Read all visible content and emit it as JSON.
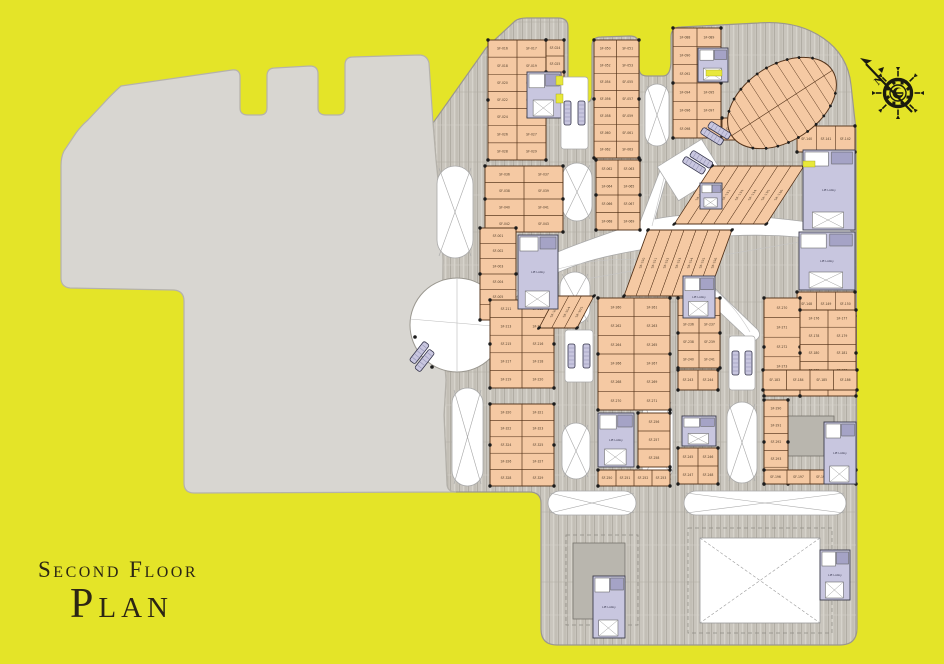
{
  "title": {
    "line1": "Second Floor",
    "line2": "Plan"
  },
  "compass": {
    "north_label": "N",
    "cx": 898,
    "cy": 93
  },
  "palette": {
    "bg": "#e4e428",
    "mass": "#d8d6d1",
    "mass_edge": "#b5b2ab",
    "hatch_base": "#c9c5bd",
    "hatch_line_dark": "#b1ada4",
    "hatch_line_light": "#d6d3cb",
    "shop_fill": "#f5c9a3",
    "shop_edge": "#54331a",
    "core_fill": "#c8c6df",
    "core_edge": "#3b3b4a",
    "core_dark": "#a5a3c6",
    "void_line": "#a8a8a8",
    "ink": "#1b1b0e",
    "label": "#4e3c29",
    "solid_block": "#b9b6ae",
    "highlight": "#e8e83a"
  },
  "plan": {
    "unit_prefix": "SF-",
    "core_label": "Lift Lobby",
    "mall_outline": "M486,48 L515,21 Q519,18 527,18 L558,18 Q568,18 568,27 L568,95 Q568,103 576,103 L584,103 Q592,103 592,95 L592,46 Q592,37 601,37 L630,36 Q639,36 639,45 L639,68 Q639,76 647,76 L663,76 Q671,76 671,60 L671,37 Q671,27 681,27 L758,23 Q797,20 823,38 Q848,55 851,85 L856,130 L857,628 Q857,645 840,645 L557,645 Q541,645 541,629 L541,503 Q541,492 529,492 L455,492 Q448,492 447,485 L444,415 L446,380 L442,330 L443,260 L440,200 L436,160 L433,123 Z",
    "mass_outline": "M121,86 L232,70 Q240,69 240,77 L240,108 Q240,115 248,115 L260,115 Q267,115 267,108 L267,76 Q267,68 275,68 L310,66 Q318,66 318,74 L318,108 Q318,115 326,115 L338,115 Q345,115 345,108 L345,65 Q345,57 353,57 L419,55 Q427,55 429,63 L433,123 L436,160 L440,200 L443,260 L442,330 L446,380 L444,415 L447,485 Q448,492 456,492 L194,493 Q184,493 184,483 L184,301 Q184,291 174,290 L70,288 Q61,287 61,278 L61,166 Q61,157 64,151 L76,133 Q82,125 88,120 L103,104 Q111,95 121,86 Z",
    "butterfly": "M503,282 C545,252 590,240 640,222 L661,168 C664,161 670,162 669,169 L655,219 C700,210 750,215 800,221 L846,227 Q852,229 852,236 Q852,243 845,242 L798,237 C752,233 706,236 668,243 L758,330 Q762,336 756,340 Q751,344 746,337 L652,248 C600,256 556,266 512,300 Q505,305 501,298 Q498,290 503,282 Z",
    "butterfly_lines": [
      "M505,293 L845,234",
      "M520,282 C610,246 700,246 750,332",
      "M652,226 L666,170"
    ],
    "walkway": {
      "x": 664,
      "y": 150,
      "w": 52,
      "h": 40,
      "rot": -32
    },
    "atrium_circle": {
      "cx": 457,
      "cy": 325,
      "r": 47
    },
    "blocks": [
      {
        "x": 488,
        "y": 40,
        "w": 58,
        "h": 120,
        "cols": 2,
        "rows": 7,
        "start": 16
      },
      {
        "x": 546,
        "y": 40,
        "w": 18,
        "h": 64,
        "cols": 1,
        "rows": 4,
        "start": 24
      },
      {
        "x": 594,
        "y": 40,
        "w": 45,
        "h": 118,
        "cols": 2,
        "rows": 7,
        "start": 50
      },
      {
        "x": 673,
        "y": 28,
        "w": 48,
        "h": 110,
        "cols": 2,
        "rows": 6,
        "start": 88
      },
      {
        "x": 797,
        "y": 126,
        "w": 58,
        "h": 26,
        "cols": 3,
        "rows": 1,
        "start": 140
      },
      {
        "x": 797,
        "y": 292,
        "w": 58,
        "h": 24,
        "cols": 3,
        "rows": 1,
        "start": 148
      },
      {
        "x": 485,
        "y": 166,
        "w": 78,
        "h": 66,
        "cols": 2,
        "rows": 4,
        "start": 36
      },
      {
        "x": 480,
        "y": 228,
        "w": 36,
        "h": 92,
        "cols": 1,
        "rows": 6,
        "start": 1
      },
      {
        "x": 490,
        "y": 300,
        "w": 64,
        "h": 88,
        "cols": 2,
        "rows": 5,
        "start": 211
      },
      {
        "x": 490,
        "y": 404,
        "w": 64,
        "h": 82,
        "cols": 2,
        "rows": 5,
        "start": 320
      },
      {
        "x": 598,
        "y": 298,
        "w": 72,
        "h": 112,
        "cols": 2,
        "rows": 6,
        "start": 260
      },
      {
        "x": 638,
        "y": 413,
        "w": 32,
        "h": 54,
        "cols": 1,
        "rows": 3,
        "start": 256
      },
      {
        "x": 598,
        "y": 470,
        "w": 72,
        "h": 16,
        "cols": 4,
        "rows": 1,
        "start": 250
      },
      {
        "x": 678,
        "y": 298,
        "w": 42,
        "h": 70,
        "cols": 2,
        "rows": 4,
        "start": 234
      },
      {
        "x": 678,
        "y": 370,
        "w": 40,
        "h": 20,
        "cols": 2,
        "rows": 1,
        "start": 243
      },
      {
        "x": 678,
        "y": 448,
        "w": 40,
        "h": 36,
        "cols": 2,
        "rows": 2,
        "start": 245
      },
      {
        "x": 764,
        "y": 298,
        "w": 36,
        "h": 98,
        "cols": 1,
        "rows": 5,
        "start": 270
      },
      {
        "x": 764,
        "y": 400,
        "w": 24,
        "h": 84,
        "cols": 1,
        "rows": 5,
        "start": 290
      },
      {
        "x": 800,
        "y": 310,
        "w": 56,
        "h": 86,
        "cols": 2,
        "rows": 5,
        "start": 176
      },
      {
        "x": 763,
        "y": 370,
        "w": 94,
        "h": 20,
        "cols": 4,
        "rows": 1,
        "start": 183
      },
      {
        "x": 764,
        "y": 470,
        "w": 92,
        "h": 14,
        "cols": 4,
        "rows": 1,
        "start": 196
      },
      {
        "x": 596,
        "y": 160,
        "w": 44,
        "h": 70,
        "cols": 2,
        "rows": 4,
        "start": 62
      },
      {
        "x": 722,
        "y": 118,
        "w": 56,
        "h": 22,
        "cols": 3,
        "rows": 1,
        "start": 110
      }
    ],
    "fans": [
      {
        "x": 648,
        "y": 230,
        "w": 84,
        "h": 66,
        "cols": 7,
        "skew": -20,
        "start": 150
      },
      {
        "x": 712,
        "y": 166,
        "w": 92,
        "h": 58,
        "cols": 7,
        "skew": -33,
        "start": 130
      },
      {
        "x": 556,
        "y": 296,
        "w": 38,
        "h": 32,
        "cols": 3,
        "skew": -28,
        "start": 203
      }
    ],
    "leaf": {
      "cx": 782,
      "cy": 103,
      "rx": 60,
      "ry": 38,
      "rot": -33,
      "chord_step": 11,
      "start": 115
    },
    "voids": [
      {
        "x": 437,
        "y": 166,
        "w": 36,
        "h": 92,
        "type": "x"
      },
      {
        "x": 452,
        "y": 388,
        "w": 31,
        "h": 98,
        "type": "x"
      },
      {
        "x": 645,
        "y": 84,
        "w": 24,
        "h": 62,
        "type": "x"
      },
      {
        "x": 562,
        "y": 163,
        "w": 30,
        "h": 58,
        "type": "x"
      },
      {
        "x": 560,
        "y": 272,
        "w": 30,
        "h": 52,
        "type": "x"
      },
      {
        "x": 562,
        "y": 423,
        "w": 28,
        "h": 56,
        "type": "x"
      },
      {
        "x": 642,
        "y": 400,
        "w": 31,
        "h": 82,
        "type": "x"
      },
      {
        "x": 727,
        "y": 402,
        "w": 30,
        "h": 81,
        "type": "x"
      },
      {
        "x": 788,
        "y": 360,
        "w": 68,
        "h": 30,
        "type": "x"
      },
      {
        "x": 548,
        "y": 491,
        "w": 88,
        "h": 24,
        "type": "x"
      },
      {
        "x": 684,
        "y": 491,
        "w": 162,
        "h": 24,
        "type": "x"
      }
    ],
    "dash_rects": [
      {
        "x": 688,
        "y": 528,
        "w": 144,
        "h": 105,
        "fillx": true
      },
      {
        "x": 566,
        "y": 535,
        "w": 72,
        "h": 90,
        "fillx": false
      }
    ],
    "solids": [
      {
        "x": 573,
        "y": 543,
        "w": 52,
        "h": 76
      },
      {
        "x": 788,
        "y": 416,
        "w": 46,
        "h": 40
      }
    ],
    "cores": [
      {
        "x": 527,
        "y": 72,
        "w": 34,
        "h": 46,
        "label": false
      },
      {
        "x": 518,
        "y": 235,
        "w": 40,
        "h": 74,
        "label": true
      },
      {
        "x": 598,
        "y": 413,
        "w": 36,
        "h": 54,
        "label": true
      },
      {
        "x": 682,
        "y": 416,
        "w": 34,
        "h": 30,
        "label": false
      },
      {
        "x": 683,
        "y": 276,
        "w": 32,
        "h": 42,
        "label": true
      },
      {
        "x": 700,
        "y": 183,
        "w": 22,
        "h": 26,
        "label": false
      },
      {
        "x": 803,
        "y": 150,
        "w": 52,
        "h": 80,
        "label": true
      },
      {
        "x": 799,
        "y": 232,
        "w": 56,
        "h": 58,
        "label": true
      },
      {
        "x": 824,
        "y": 422,
        "w": 32,
        "h": 62,
        "label": true
      },
      {
        "x": 593,
        "y": 576,
        "w": 32,
        "h": 62,
        "label": true
      },
      {
        "x": 820,
        "y": 550,
        "w": 30,
        "h": 50,
        "label": true
      },
      {
        "x": 698,
        "y": 48,
        "w": 30,
        "h": 34,
        "label": false
      }
    ],
    "escalator_bays": [
      {
        "x": 561,
        "y": 77,
        "w": 27,
        "h": 72
      },
      {
        "x": 565,
        "y": 330,
        "w": 28,
        "h": 52
      },
      {
        "x": 729,
        "y": 336,
        "w": 26,
        "h": 54
      }
    ],
    "escalator_pairs": [
      {
        "x": 424,
        "y": 341,
        "rot": 38
      },
      {
        "x": 682,
        "y": 162,
        "rot": -58
      },
      {
        "x": 700,
        "y": 133,
        "rot": -58
      },
      {
        "x": 330,
        "y": -999,
        "rot": 0
      }
    ],
    "highlights": [
      {
        "x": 556,
        "y": 76,
        "w": 7,
        "h": 9
      },
      {
        "x": 556,
        "y": 94,
        "w": 7,
        "h": 9
      },
      {
        "x": 706,
        "y": 70,
        "w": 16,
        "h": 6
      },
      {
        "x": 803,
        "y": 161,
        "w": 12,
        "h": 6
      }
    ]
  }
}
